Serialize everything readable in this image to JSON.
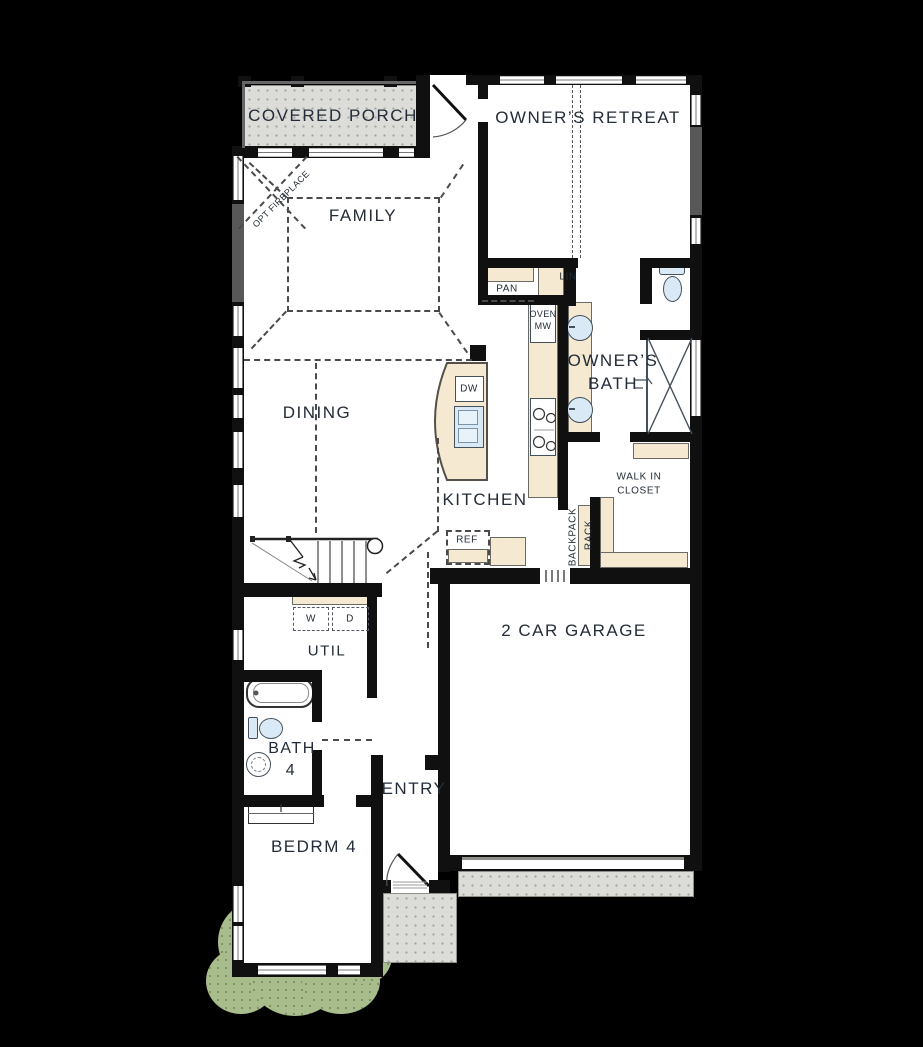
{
  "rooms": {
    "covered_porch": "COVERED PORCH",
    "owners_retreat": "OWNER’S RETREAT",
    "family": "FAMILY",
    "dining": "DINING",
    "kitchen": "KITCHEN",
    "owners_bath_l1": "OWNER’S",
    "owners_bath_l2": "BATH",
    "walk_in_closet_l1": "WALK IN",
    "walk_in_closet_l2": "CLOSET",
    "garage": "2 CAR GARAGE",
    "util": "UTIL",
    "bath4_l1": "BATH",
    "bath4_l2": "4",
    "entry": "ENTRY",
    "bedrm4": "BEDRM 4"
  },
  "features": {
    "opt_fireplace": "OPT FIREPLACE",
    "pantry": "PAN",
    "linen": "LIN",
    "oven_l1": "OVEN",
    "oven_l2": "MW",
    "dishwasher": "DW",
    "refrigerator": "REF",
    "backpack_l1": "BACKPACK",
    "backpack_l2": "RACK",
    "washer": "W",
    "dryer": "D"
  },
  "colors": {
    "background": "#000000",
    "wall": "#101010",
    "floor": "#ffffff",
    "paving": "#dcdcd8",
    "cabinet": "#f5e9d2",
    "fixture": "#d9eaf6",
    "shrub": "#a9bc8c",
    "label_text": "#232c38",
    "accent_wall": "#585858"
  }
}
